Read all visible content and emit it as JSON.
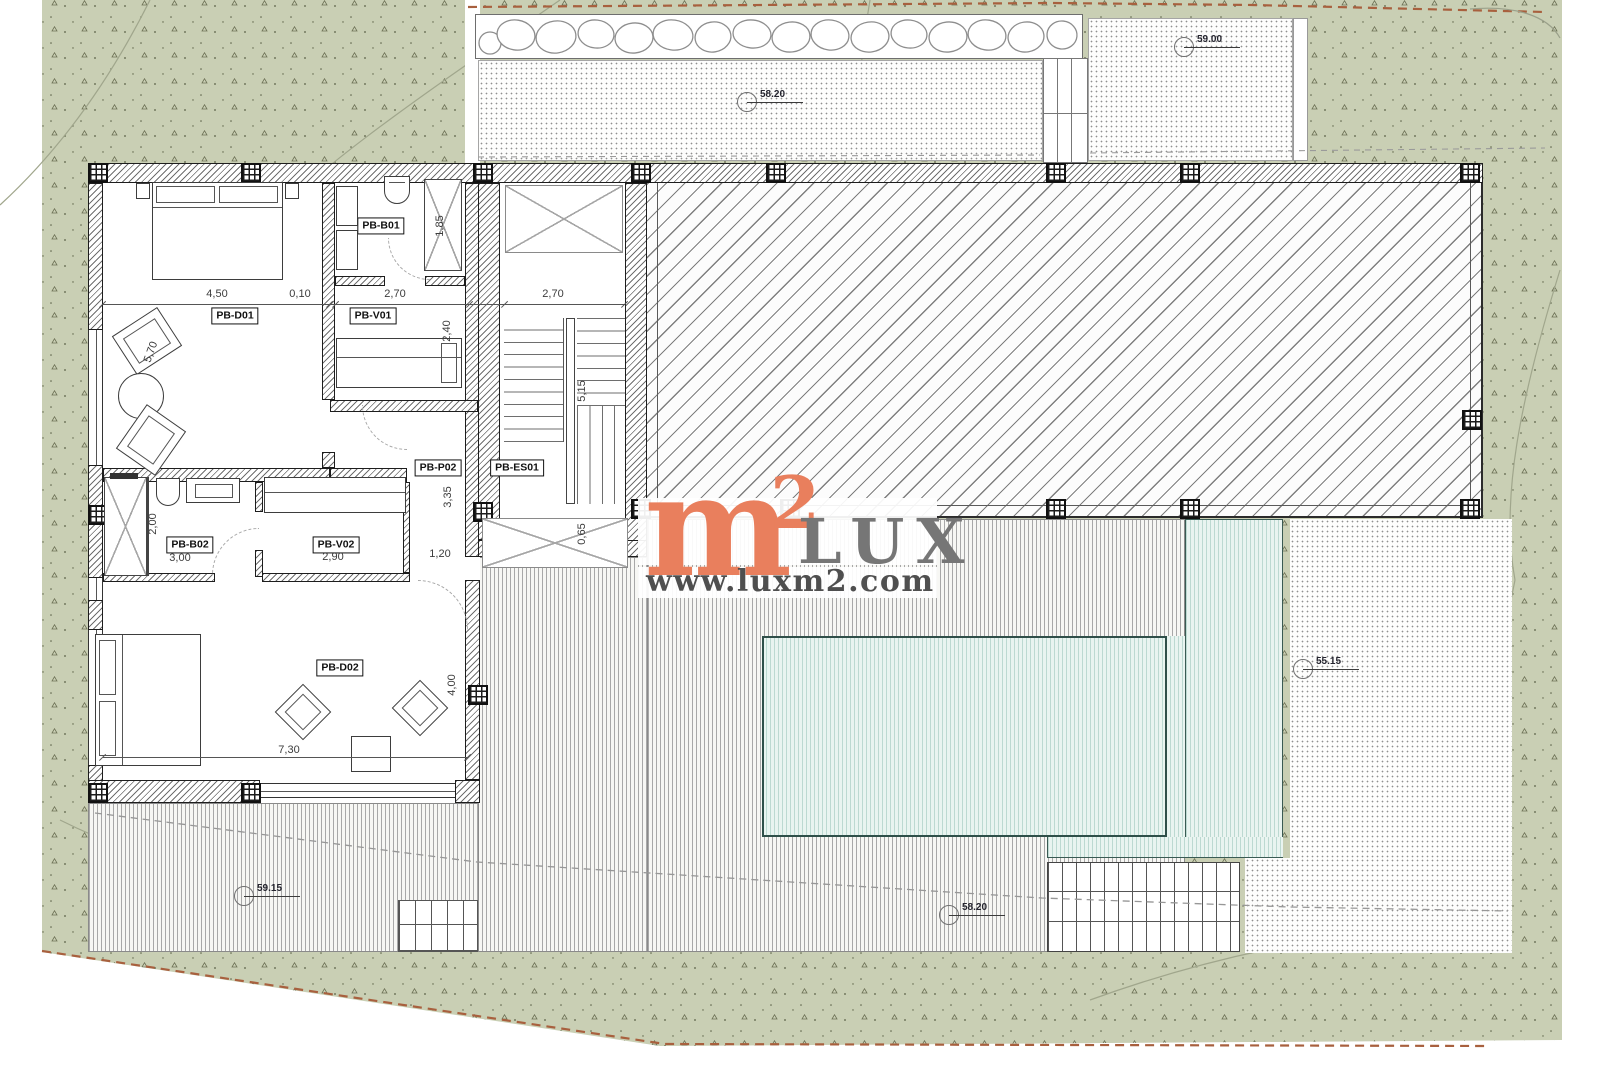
{
  "watermark": {
    "m": "m",
    "sup": "2",
    "brand": "LUX",
    "url": "www.luxm2.com"
  },
  "rooms": [
    {
      "label": "PB-D01"
    },
    {
      "label": "PB-B01"
    },
    {
      "label": "PB-V01"
    },
    {
      "label": "PB-P02"
    },
    {
      "label": "PB-ES01"
    },
    {
      "label": "PB-B02"
    },
    {
      "label": "PB-V02"
    },
    {
      "label": "PB-D02"
    }
  ],
  "dims": [
    {
      "text": "4,50"
    },
    {
      "text": "0,10"
    },
    {
      "text": "2,70"
    },
    {
      "text": "2,70"
    },
    {
      "text": "1,85"
    },
    {
      "text": "2,40"
    },
    {
      "text": "5,70"
    },
    {
      "text": "3,35"
    },
    {
      "text": "5,15"
    },
    {
      "text": "0,65"
    },
    {
      "text": "2,00"
    },
    {
      "text": "3,00"
    },
    {
      "text": "2,90"
    },
    {
      "text": "1,20"
    },
    {
      "text": "7,30"
    },
    {
      "text": "4,00"
    }
  ],
  "elevations": [
    {
      "text": "58.20"
    },
    {
      "text": "59.00"
    },
    {
      "text": "55.15"
    },
    {
      "text": "59.15"
    },
    {
      "text": "58.20"
    }
  ],
  "colors": {
    "terrain": "#c9cfb4",
    "speckle": "#636a4d",
    "pool": "#e9f4f0",
    "pool_stripe": "#bcd9d1",
    "watermark_orange": "#e97f5d",
    "watermark_gray": "#767676",
    "boundary_red": "#a8603e",
    "hatch": "#7e7e7e"
  }
}
